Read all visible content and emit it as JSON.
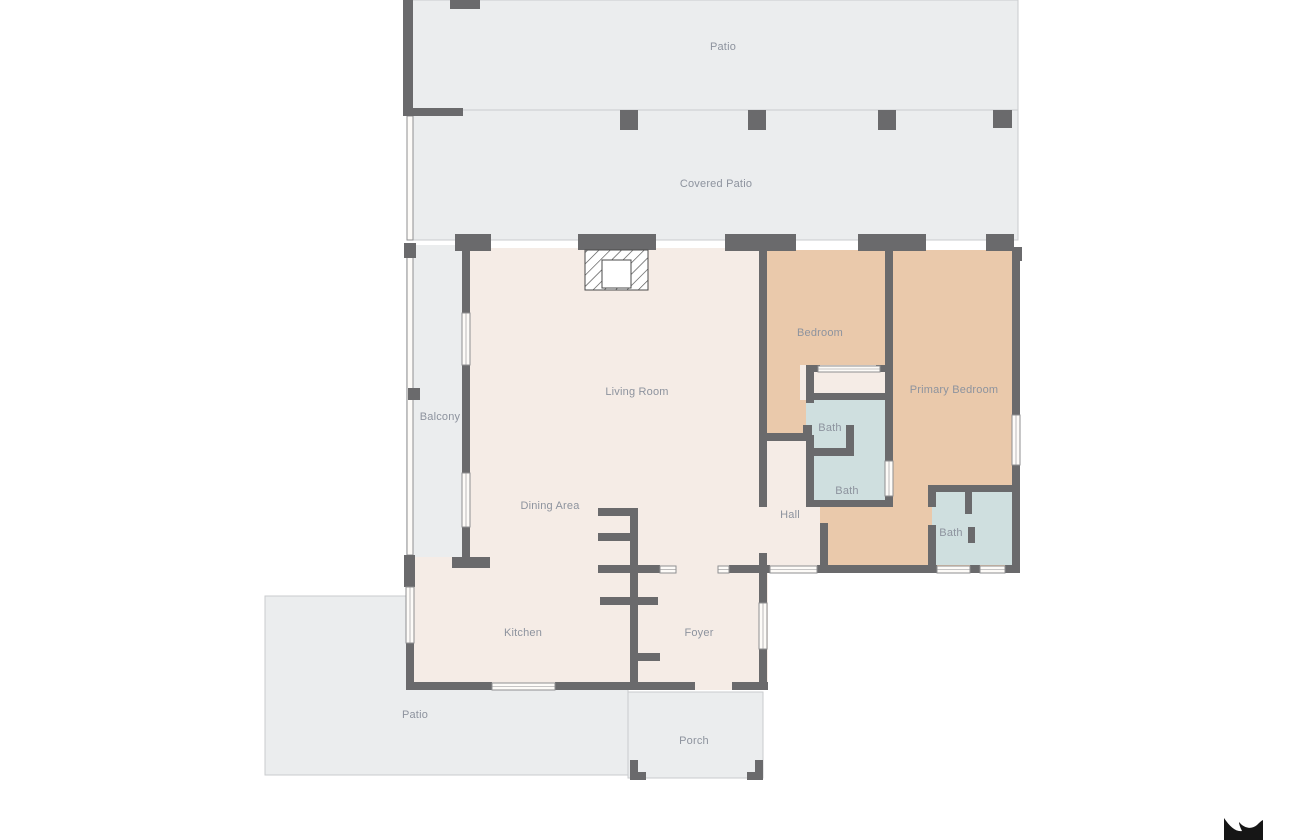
{
  "canvas": {
    "width": 1290,
    "height": 840,
    "background": "#ffffff"
  },
  "palette": {
    "wall": "#6a6a6c",
    "area_gray": "#ebedee",
    "floor_cream": "#f5ece6",
    "floor_tan": "#eac9ab",
    "floor_blue": "#cfdfdf",
    "window_fill": "#fdfbf8",
    "window_stroke": "#8f8f91",
    "area_outline": "#c9cbce",
    "hatch_stroke": "#4a4a4a",
    "label_text": "#8d939e",
    "logo": "#161616"
  },
  "rooms": [
    {
      "id": "patio-top",
      "x": 408,
      "y": 0,
      "w": 610,
      "h": 110,
      "fill": "area_gray",
      "outline": true
    },
    {
      "id": "covered-patio",
      "x": 408,
      "y": 110,
      "w": 610,
      "h": 130,
      "fill": "area_gray",
      "outline": true
    },
    {
      "id": "patio-bottom",
      "x": 265,
      "y": 596,
      "w": 363,
      "h": 179,
      "fill": "area_gray",
      "outline": true
    },
    {
      "id": "porch",
      "x": 628,
      "y": 692,
      "w": 135,
      "h": 86,
      "fill": "area_gray",
      "outline": true
    },
    {
      "id": "balcony",
      "x": 406,
      "y": 245,
      "w": 61,
      "h": 323,
      "fill": "area_gray",
      "outline": false
    },
    {
      "id": "living-dining",
      "x": 466,
      "y": 248,
      "w": 299,
      "h": 320,
      "fill": "floor_cream",
      "outline": false
    },
    {
      "id": "kitchen-foyer",
      "x": 408,
      "y": 557,
      "w": 360,
      "h": 133,
      "fill": "floor_cream",
      "outline": false
    },
    {
      "id": "hall",
      "x": 754,
      "y": 425,
      "w": 66,
      "h": 148,
      "fill": "floor_cream",
      "outline": false
    },
    {
      "id": "bedroom",
      "x": 767,
      "y": 250,
      "w": 126,
      "h": 185,
      "fill": "floor_tan",
      "outline": false
    },
    {
      "id": "primary-bedroom",
      "x": 893,
      "y": 250,
      "w": 127,
      "h": 323,
      "fill": "floor_tan",
      "outline": false
    },
    {
      "id": "suite-passage",
      "x": 820,
      "y": 507,
      "w": 73,
      "h": 58,
      "fill": "floor_tan",
      "outline": false
    },
    {
      "id": "closet",
      "x": 800,
      "y": 365,
      "w": 90,
      "h": 35,
      "fill": "floor_cream",
      "outline": false
    },
    {
      "id": "bath-top",
      "x": 806,
      "y": 400,
      "w": 87,
      "h": 48,
      "fill": "floor_blue",
      "outline": false
    },
    {
      "id": "bath-middle",
      "x": 806,
      "y": 448,
      "w": 87,
      "h": 59,
      "fill": "floor_blue",
      "outline": false
    },
    {
      "id": "bath-right",
      "x": 932,
      "y": 487,
      "w": 88,
      "h": 78,
      "fill": "floor_blue",
      "outline": false
    }
  ],
  "railings": [
    [
      407,
      116,
      6,
      124
    ],
    [
      407,
      245,
      6,
      310
    ]
  ],
  "walls": [
    [
      403,
      0,
      10,
      116
    ],
    [
      450,
      0,
      30,
      9
    ],
    [
      403,
      108,
      60,
      8
    ],
    [
      620,
      110,
      18,
      20
    ],
    [
      748,
      110,
      18,
      20
    ],
    [
      878,
      110,
      18,
      20
    ],
    [
      993,
      110,
      19,
      18
    ],
    [
      455,
      234,
      36,
      17
    ],
    [
      578,
      234,
      78,
      16
    ],
    [
      725,
      234,
      71,
      17
    ],
    [
      858,
      234,
      68,
      17
    ],
    [
      986,
      234,
      28,
      17
    ],
    [
      1012,
      247,
      10,
      14
    ],
    [
      462,
      251,
      8,
      62
    ],
    [
      462,
      365,
      8,
      108
    ],
    [
      462,
      527,
      8,
      32
    ],
    [
      452,
      557,
      38,
      11
    ],
    [
      759,
      251,
      8,
      256
    ],
    [
      759,
      553,
      8,
      20
    ],
    [
      767,
      433,
      38,
      8
    ],
    [
      803,
      425,
      9,
      16
    ],
    [
      806,
      365,
      8,
      38
    ],
    [
      806,
      365,
      14,
      7
    ],
    [
      876,
      365,
      14,
      7
    ],
    [
      806,
      393,
      84,
      7
    ],
    [
      806,
      435,
      8,
      72
    ],
    [
      806,
      448,
      47,
      8
    ],
    [
      846,
      425,
      8,
      31
    ],
    [
      806,
      500,
      87,
      7
    ],
    [
      885,
      251,
      8,
      210
    ],
    [
      885,
      496,
      8,
      11
    ],
    [
      1012,
      261,
      8,
      154
    ],
    [
      1012,
      465,
      8,
      108
    ],
    [
      729,
      565,
      41,
      8
    ],
    [
      817,
      565,
      13,
      8
    ],
    [
      830,
      565,
      107,
      8
    ],
    [
      970,
      565,
      10,
      8
    ],
    [
      1005,
      565,
      15,
      8
    ],
    [
      820,
      523,
      8,
      45
    ],
    [
      928,
      485,
      92,
      7
    ],
    [
      928,
      485,
      8,
      22
    ],
    [
      928,
      525,
      8,
      48
    ],
    [
      965,
      492,
      7,
      22
    ],
    [
      968,
      527,
      7,
      16
    ],
    [
      630,
      508,
      8,
      182
    ],
    [
      598,
      508,
      32,
      8
    ],
    [
      598,
      533,
      32,
      8
    ],
    [
      598,
      565,
      32,
      8
    ],
    [
      638,
      565,
      22,
      8
    ],
    [
      600,
      597,
      30,
      8
    ],
    [
      638,
      597,
      20,
      8
    ],
    [
      638,
      653,
      22,
      8
    ],
    [
      404,
      555,
      11,
      32
    ],
    [
      406,
      643,
      8,
      47
    ],
    [
      406,
      682,
      86,
      8
    ],
    [
      555,
      682,
      140,
      8
    ],
    [
      732,
      682,
      36,
      8
    ],
    [
      759,
      573,
      8,
      30
    ],
    [
      759,
      649,
      8,
      41
    ],
    [
      745,
      682,
      23,
      8
    ],
    [
      630,
      760,
      8,
      20
    ],
    [
      630,
      772,
      16,
      8
    ],
    [
      755,
      760,
      8,
      20
    ],
    [
      747,
      772,
      16,
      8
    ],
    [
      404,
      243,
      12,
      15
    ],
    [
      408,
      388,
      12,
      12
    ]
  ],
  "windows": [
    [
      462,
      313,
      8,
      52
    ],
    [
      462,
      473,
      8,
      54
    ],
    [
      406,
      587,
      8,
      56
    ],
    [
      492,
      683,
      63,
      7
    ],
    [
      660,
      566,
      16,
      7
    ],
    [
      718,
      566,
      11,
      7
    ],
    [
      770,
      566,
      47,
      7
    ],
    [
      937,
      566,
      33,
      7
    ],
    [
      980,
      566,
      25,
      7
    ],
    [
      885,
      461,
      8,
      35
    ],
    [
      1012,
      415,
      8,
      50
    ],
    [
      759,
      603,
      8,
      46
    ],
    [
      818,
      366,
      62,
      6
    ]
  ],
  "fireplace": {
    "x": 585,
    "y": 250,
    "w": 63,
    "h": 40,
    "inner": {
      "x": 602,
      "y": 260,
      "w": 29,
      "h": 28
    }
  },
  "labels": [
    {
      "id": "patio-top",
      "text": "Patio",
      "x": 723,
      "y": 47
    },
    {
      "id": "covered-patio",
      "text": "Covered Patio",
      "x": 716,
      "y": 184
    },
    {
      "id": "living-room",
      "text": "Living Room",
      "x": 637,
      "y": 392
    },
    {
      "id": "balcony",
      "text": "Balcony",
      "x": 440,
      "y": 417
    },
    {
      "id": "bedroom",
      "text": "Bedroom",
      "x": 820,
      "y": 333
    },
    {
      "id": "primary-bedroom",
      "text": "Primary Bedroom",
      "x": 954,
      "y": 390
    },
    {
      "id": "bath-top",
      "text": "Bath",
      "x": 830,
      "y": 428
    },
    {
      "id": "bath-middle",
      "text": "Bath",
      "x": 847,
      "y": 491
    },
    {
      "id": "bath-right",
      "text": "Bath",
      "x": 951,
      "y": 533
    },
    {
      "id": "hall",
      "text": "Hall",
      "x": 790,
      "y": 515
    },
    {
      "id": "dining-area",
      "text": "Dining Area",
      "x": 550,
      "y": 506
    },
    {
      "id": "kitchen",
      "text": "Kitchen",
      "x": 523,
      "y": 633
    },
    {
      "id": "foyer",
      "text": "Foyer",
      "x": 699,
      "y": 633
    },
    {
      "id": "patio-bottom",
      "text": "Patio",
      "x": 415,
      "y": 715
    },
    {
      "id": "porch",
      "text": "Porch",
      "x": 694,
      "y": 741
    }
  ],
  "logo": {
    "x": 1220,
    "y": 814,
    "path": "M4 4 C10 13 16 18 22 17 C20 13 19 10 19 8 C24 14 31 16 37 11 C39 9 41 7 43 6 L43 28 L4 28 Z"
  }
}
